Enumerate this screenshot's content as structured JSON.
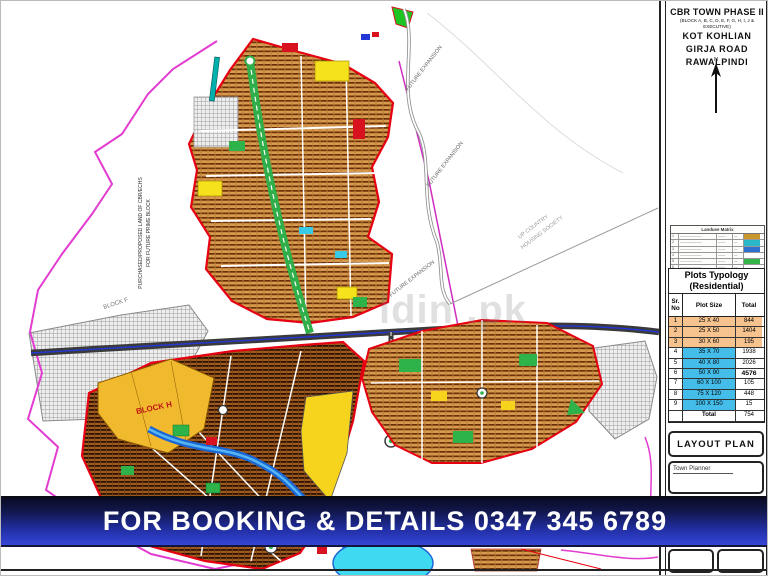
{
  "title_block": {
    "project": "CBR TOWN PHASE II",
    "blocks_note": "(BLOCK A, B, C, D, E, F, G, H, I, J & EXECUTIVE)",
    "location_line1": "KOT KOHLIAN",
    "location_line2": "GIRJA  ROAD",
    "location_line3": "RAWALPINDI",
    "north_label": "N"
  },
  "landuse_matrix": {
    "title": "Landuse Matrix",
    "rows": [
      {
        "sr": "1",
        "label": "——————",
        "a": "——",
        "b": "—",
        "swatch": "#c8962a"
      },
      {
        "sr": "2",
        "label": "——————",
        "a": "——",
        "b": "—",
        "swatch": "#28b8c8"
      },
      {
        "sr": "3",
        "label": "——————",
        "a": "——",
        "b": "—",
        "swatch": "#2e6fd0"
      },
      {
        "sr": "4",
        "label": "——————",
        "a": "——",
        "b": "—",
        "swatch": "#ffffff"
      },
      {
        "sr": "5",
        "label": "——————",
        "a": "——",
        "b": "—",
        "swatch": "#35b44a"
      },
      {
        "sr": "6",
        "label": "——————",
        "a": "——",
        "b": "—",
        "swatch": "#ffffff"
      }
    ]
  },
  "plots_table": {
    "title": "Plots Typology",
    "subtitle": "(Residential)",
    "headers": {
      "sr": "Sr. No",
      "size": "Plot Size",
      "total": "Total"
    },
    "rows": [
      {
        "sr": "1",
        "size": "25 X 40",
        "total": "844"
      },
      {
        "sr": "2",
        "size": "25 X 50",
        "total": "1404"
      },
      {
        "sr": "3",
        "size": "30 X 60",
        "total": "195"
      },
      {
        "sr": "4",
        "size": "35 X 70",
        "total": "1938"
      },
      {
        "sr": "5",
        "size": "40 X 80",
        "total": "2026"
      },
      {
        "sr": "6",
        "size": "50 X 90",
        "total": "4576"
      },
      {
        "sr": "7",
        "size": "60 X 100",
        "total": "105"
      },
      {
        "sr": "8",
        "size": "75 X 120",
        "total": "448"
      },
      {
        "sr": "9",
        "size": "100 X 150",
        "total": "15"
      }
    ],
    "total_label": "Total",
    "total_value": "754"
  },
  "layout_plan_label": "LAYOUT PLAN",
  "town_planner_label": "Town Planner",
  "banner": {
    "text": "FOR BOOKING & DETAILS 0347 345 6789"
  },
  "map": {
    "labels": {
      "purchased_land_1": "PURCHASED/PROPOSED LAND OF CBR/ECHS",
      "purchased_land_2": "FOR FUTURE PRIME BLOCK",
      "future_expansion": "FUTURE EXPANSION",
      "up_country_1": "UP COUNTRY",
      "up_country_2": "HOUSING SOCIETY",
      "block_f": "BLOCK F",
      "block_h": "BLOCK H",
      "watermark": "ldin .pk"
    },
    "colors": {
      "boundary_red": "#e60012",
      "boundary_magenta": "#e23cd0",
      "plots_fill": "#d89a4e",
      "road_green": "#2fae4a",
      "water_blue": "#1b66d6",
      "pond_cyan": "#3fd9f2",
      "park_green": "#2db34a",
      "commercial_yellow": "#f6d31d",
      "block_h_yellow": "#f0b92e"
    }
  }
}
